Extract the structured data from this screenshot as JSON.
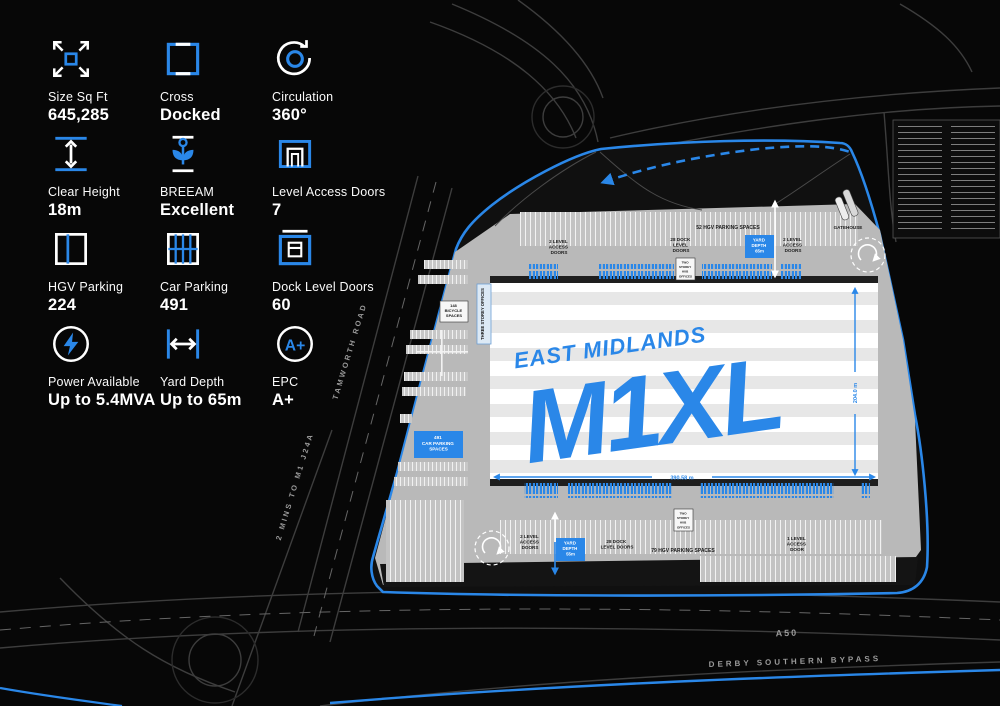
{
  "accent": "#2a87e8",
  "specs": [
    {
      "label": "Size Sq Ft",
      "value": "645,285"
    },
    {
      "label": "Cross",
      "value": "Docked"
    },
    {
      "label": "Circulation",
      "value": "360°"
    },
    {
      "label": "Clear Height",
      "value": "18m"
    },
    {
      "label": "BREEAM",
      "value": "Excellent"
    },
    {
      "label": "Level Access Doors",
      "value": "7"
    },
    {
      "label": "HGV Parking",
      "value": "224"
    },
    {
      "label": "Car Parking",
      "value": "491"
    },
    {
      "label": "Dock Level Doors",
      "value": "60"
    },
    {
      "label": "Power Available",
      "value": "Up to 5.4MVA"
    },
    {
      "label": "Yard Depth",
      "value": "Up to 65m"
    },
    {
      "label": "EPC",
      "value": "A+"
    }
  ],
  "plan": {
    "logo": {
      "line1": "EAST MIDLANDS",
      "line2": "M1XL"
    },
    "hgv_top": "52 HGV PARKING SPACES",
    "hgv_bottom": "79 HGV PARKING SPACES",
    "dock_top": [
      "28 DOCK",
      "LEVEL",
      "DOORS"
    ],
    "dock_bottom": [
      "28 DOCK",
      "LEVEL DOORS"
    ],
    "lad2": [
      "2 LEVEL",
      "ACCESS",
      "DOORS"
    ],
    "lad1": [
      "1 LEVEL",
      "ACCESS",
      "DOOR"
    ],
    "yard65": [
      "YARD",
      "DEPTH",
      "65m"
    ],
    "yard55": [
      "YARD",
      "DEPTH",
      "55m"
    ],
    "gatehouse": "GATEHOUSE",
    "bicycle": [
      "148",
      "BICYCLE",
      "SPACES"
    ],
    "carpark": [
      "491",
      "CAR PARKING",
      "SPACES"
    ],
    "offices": "THREE STOREY OFFICES",
    "hub": [
      "TWO",
      "STOREY",
      "HUB",
      "OFFICES"
    ],
    "dim_width": "390.58 m",
    "dim_height": "204.0 m"
  },
  "roads": {
    "tamworth": "TAMWORTH ROAD",
    "m1": "2 MINS TO M1 J24A",
    "a50": "A50",
    "bypass": "DERBY SOUTHERN BYPASS"
  }
}
